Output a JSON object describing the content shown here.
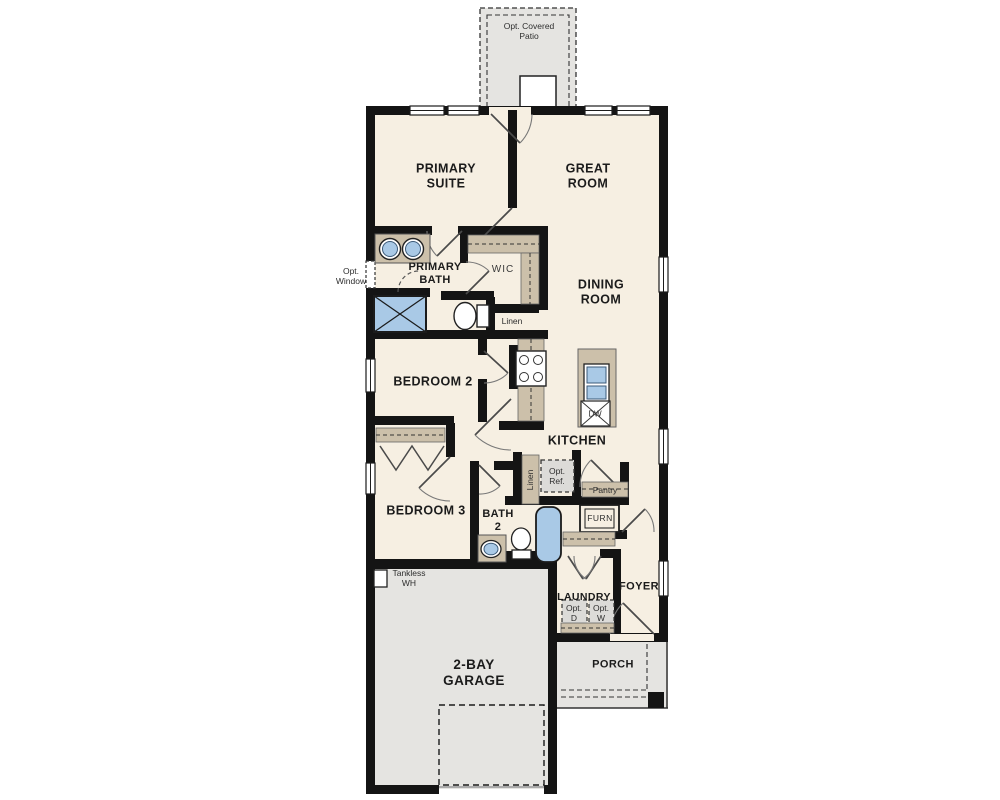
{
  "floorplan": {
    "labels": {
      "patio": "Opt. Covered\nPatio",
      "primary_suite": "PRIMARY\nSUITE",
      "great_room": "GREAT\nROOM",
      "opt_window": "Opt.\nWindow",
      "primary_bath": "PRIMARY\nBATH",
      "wic": "WIC",
      "linen_wic": "Linen",
      "dining_room": "DINING\nROOM",
      "bedroom2": "BEDROOM 2",
      "kitchen": "KITCHEN",
      "dw": "DW",
      "bedroom3": "BEDROOM 3",
      "linen_hall": "Linen",
      "opt_ref": "Opt.\nRef.",
      "pantry": "Pantry",
      "bath2": "BATH\n2",
      "furn": "FURN",
      "tankless_wh": "Tankless\nWH",
      "laundry": "LAUNDRY",
      "opt_dryer": "Opt.\nD",
      "opt_washer": "Opt.\nW",
      "foyer": "FOYER",
      "garage": "2-BAY\nGARAGE",
      "porch": "PORCH"
    },
    "colors": {
      "floor_cream": "#f6efe2",
      "outdoor_gray": "#e5e4e1",
      "cabinet_tan": "#ccc0aa",
      "fixture_blue": "#a9c9e6",
      "appliance_gray": "#dcdbd8",
      "wall_black": "#141414"
    }
  }
}
